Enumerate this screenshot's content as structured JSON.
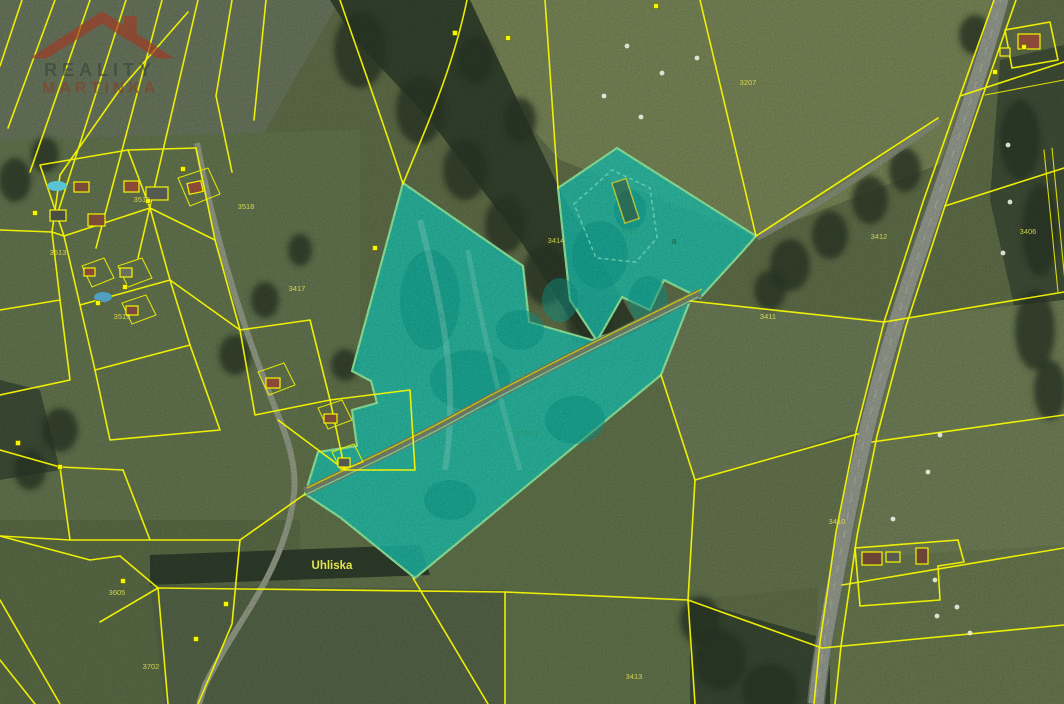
{
  "watermark": {
    "line1": "REALITY",
    "line2": "MARTINKA"
  },
  "map": {
    "place_label": {
      "text": "Uhliska",
      "x": 332,
      "y": 569
    },
    "parcel_labels": [
      {
        "text": "3207",
        "x": 748,
        "y": 85
      },
      {
        "text": "3412",
        "x": 879,
        "y": 239
      },
      {
        "text": "3413",
        "x": 634,
        "y": 679
      },
      {
        "text": "3414",
        "x": 556,
        "y": 243
      },
      {
        "text": "3406",
        "x": 1028,
        "y": 234
      },
      {
        "text": "3410",
        "x": 837,
        "y": 524
      },
      {
        "text": "3411",
        "x": 768,
        "y": 319
      },
      {
        "text": "3515",
        "x": 142,
        "y": 202
      },
      {
        "text": "3513",
        "x": 58,
        "y": 255
      },
      {
        "text": "3518",
        "x": 246,
        "y": 209
      },
      {
        "text": "3417",
        "x": 297,
        "y": 291
      },
      {
        "text": "3519",
        "x": 122,
        "y": 319
      },
      {
        "text": "3605",
        "x": 117,
        "y": 595
      },
      {
        "text": "3702",
        "x": 151,
        "y": 669
      }
    ],
    "highlight_labels": [
      {
        "text": "3713",
        "x": 447,
        "y": 318
      },
      {
        "text": "3713/1",
        "x": 527,
        "y": 436
      },
      {
        "text": "3712",
        "x": 629,
        "y": 234
      }
    ],
    "letter_markers": [
      {
        "text": "a",
        "x": 674,
        "y": 244
      }
    ],
    "colors": {
      "parcel_line": "#f6f600",
      "highlight_fill": "#1ecdb9",
      "highlight_stroke": "#97f5a5",
      "label_yellow": "#e6e655",
      "label_green": "#2e8f5f",
      "place_label_color": "#e4e44a"
    },
    "hay_bales": [
      [
        627,
        46
      ],
      [
        662,
        73
      ],
      [
        641,
        117
      ],
      [
        697,
        58
      ],
      [
        604,
        96
      ],
      [
        1008,
        145
      ],
      [
        1010,
        202
      ],
      [
        1003,
        253
      ],
      [
        935,
        580
      ],
      [
        957,
        607
      ],
      [
        937,
        616
      ],
      [
        970,
        633
      ],
      [
        893,
        519
      ],
      [
        940,
        435
      ],
      [
        928,
        472
      ]
    ],
    "dot_markers": [
      [
        508,
        38
      ],
      [
        656,
        6
      ],
      [
        35,
        213
      ],
      [
        98,
        303
      ],
      [
        125,
        287
      ],
      [
        183,
        169
      ],
      [
        148,
        201
      ],
      [
        18,
        443
      ],
      [
        60,
        467
      ],
      [
        123,
        581
      ],
      [
        196,
        639
      ],
      [
        226,
        604
      ],
      [
        995,
        72
      ],
      [
        1024,
        47
      ],
      [
        455,
        33
      ],
      [
        375,
        248
      ]
    ]
  }
}
